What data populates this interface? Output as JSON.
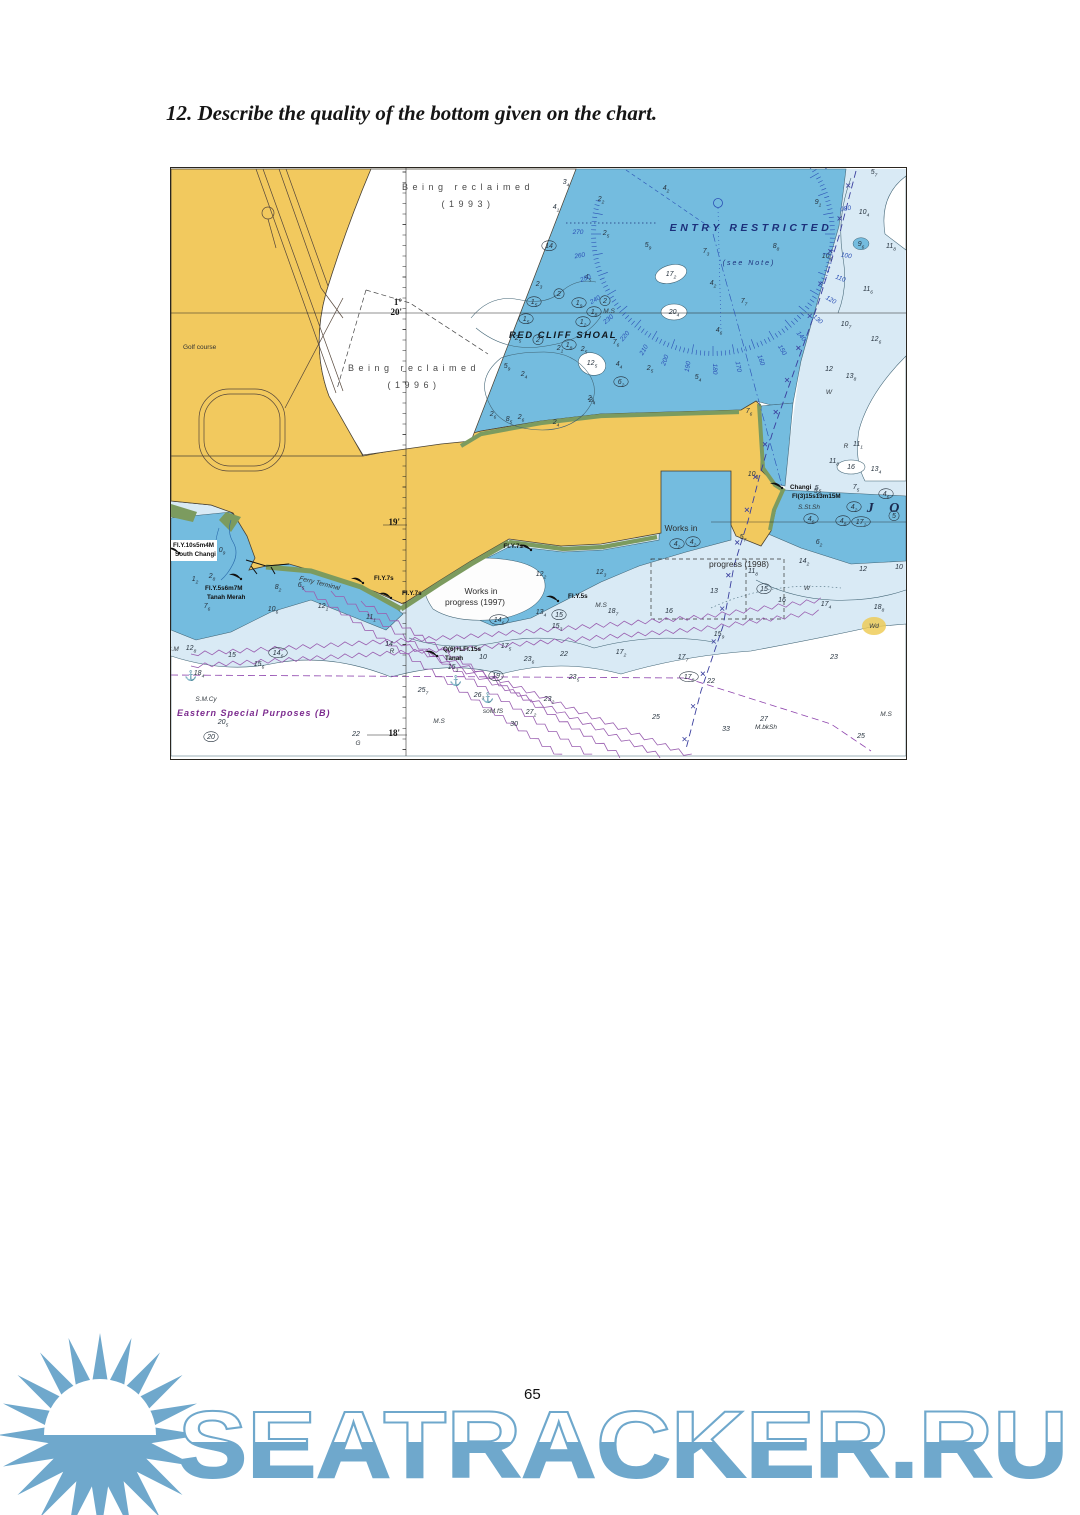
{
  "page": {
    "heading": "12. Describe the quality of the bottom given on the chart.",
    "page_number": "65"
  },
  "watermark": {
    "text": "SEATRACKER.RU",
    "color": "#6fa8cc"
  },
  "chart": {
    "colors": {
      "land": "#f2c95e",
      "green": "#7c9b5f",
      "water": "#74bcdf",
      "shallow_pale": "#d9eaf5",
      "deep": "#ffffff",
      "contour": "#3f6273",
      "sounding": "#26323e",
      "compass": "#2b50b5",
      "navy": "#1c2f7a",
      "cable_purple": "#9a5fb0",
      "anchorage_purple": "#8e44ad",
      "magenta": "#7b2a8e",
      "boundary": "#3a3f9e",
      "highlight": "#edc94f"
    },
    "labels": {
      "reclaimed_1993_l1": "Being reclaimed",
      "reclaimed_1993_l2": "(1993)",
      "reclaimed_1996_l1": "Being reclaimed",
      "reclaimed_1996_l2": "(1996)",
      "entry_restricted": "ENTRY   RESTRICTED",
      "see_note": "(see Note)",
      "red_cliff_shoal": "RED CLIFF SHOAL",
      "golf_course": "Golf course",
      "works_1998_l1": "Works in",
      "works_1998_l2": "progress (1998)",
      "works_1997_l1": "Works in",
      "works_1997_l2": "progress (1997)",
      "eastern_special": "Eastern Special Purposes  (B)",
      "ferry_terminal": "Ferry Terminal",
      "johor": "J O",
      "lat_deg": "1°",
      "lat_20": "20'",
      "lat_19": "19'",
      "lat_18": "18'"
    },
    "areas": [
      {
        "t": "Being reclaimed",
        "x": 297,
        "y": 22,
        "cls": "recl",
        "a": "middle"
      },
      {
        "t": "(1993)",
        "x": 297,
        "y": 39,
        "cls": "recl",
        "a": "middle"
      },
      {
        "t": "Being reclaimed",
        "x": 243,
        "y": 203,
        "cls": "recl",
        "a": "middle"
      },
      {
        "t": "(1996)",
        "x": 243,
        "y": 220,
        "cls": "recl",
        "a": "middle"
      },
      {
        "t": "ENTRY   RESTRICTED",
        "x": 580,
        "y": 63,
        "cls": "entry",
        "a": "middle"
      },
      {
        "t": "(see Note)",
        "x": 578,
        "y": 97,
        "cls": "note",
        "a": "middle"
      },
      {
        "t": "RED CLIFF SHOAL",
        "x": 392,
        "y": 170,
        "cls": "shoal",
        "a": "middle"
      },
      {
        "t": "Golf course",
        "x": 12,
        "y": 181,
        "cls": "golf",
        "a": "start"
      },
      {
        "t": "Works in",
        "x": 510,
        "y": 363,
        "cls": "works",
        "a": "middle"
      },
      {
        "t": "progress (1998)",
        "x": 568,
        "y": 399,
        "cls": "works",
        "a": "middle"
      },
      {
        "t": "Works in",
        "x": 310,
        "y": 426,
        "cls": "works",
        "a": "middle"
      },
      {
        "t": "progress (1997)",
        "x": 304,
        "y": 437,
        "cls": "works",
        "a": "middle"
      },
      {
        "t": "Eastern Special Purposes  (B)",
        "x": 6,
        "y": 548,
        "cls": "esp",
        "a": "start"
      },
      {
        "t": "Ferry Terminal",
        "x": 128,
        "y": 412,
        "cls": "ferry",
        "a": "start",
        "r": 14
      },
      {
        "t": "J O",
        "x": 715,
        "y": 344,
        "cls": "jo",
        "a": "middle"
      },
      {
        "t": "1°",
        "x": 231,
        "y": 137,
        "cls": "lat",
        "a": "end"
      },
      {
        "t": "20'",
        "x": 231,
        "y": 147,
        "cls": "lat",
        "a": "end"
      },
      {
        "t": "19'",
        "x": 229,
        "y": 357,
        "cls": "lat",
        "a": "end"
      },
      {
        "t": "18'",
        "x": 229,
        "y": 568,
        "cls": "lat",
        "a": "end"
      }
    ],
    "lights": [
      {
        "fx": 8,
        "fy": 385,
        "tx": 2,
        "ty": 379,
        "t1": "Fl.Y.10s5m4M",
        "t2": "South Changi",
        "bg": true
      },
      {
        "fx": 70,
        "fy": 411,
        "tx": 34,
        "ty": 422,
        "t1": "Fl.Y.5s6m7M",
        "t2": "Tanah Merah"
      },
      {
        "fx": 360,
        "fy": 382,
        "tx": 352,
        "ty": 380,
        "t1": "Fl.Y.7s",
        "a": "end"
      },
      {
        "fx": 192,
        "fy": 415,
        "tx": 203,
        "ty": 412,
        "t1": "Fl.Y.7s"
      },
      {
        "fx": 220,
        "fy": 430,
        "tx": 231,
        "ty": 427,
        "t1": "Fl.Y.7s"
      },
      {
        "fx": 387,
        "fy": 433,
        "tx": 397,
        "ty": 430,
        "t1": "Fl.Y.5s"
      },
      {
        "fx": 611,
        "fy": 320,
        "tx": 619,
        "ty": 321,
        "t1": "Changi",
        "t2": "Fl(3)15s13m15M"
      },
      {
        "fx": 266,
        "fy": 488,
        "tx": 272,
        "ty": 483,
        "t1": "Q(6)+LFl.15s",
        "t2": "Tanah"
      }
    ],
    "soundings": [
      [
        395,
        16,
        "3",
        "4"
      ],
      [
        385,
        41,
        "4",
        "1"
      ],
      [
        430,
        33,
        "2",
        "2"
      ],
      [
        435,
        67,
        "2",
        "5"
      ],
      [
        495,
        22,
        "4",
        "2"
      ],
      [
        477,
        79,
        "5",
        "9"
      ],
      [
        535,
        85,
        "7",
        "3"
      ],
      [
        605,
        80,
        "8",
        "8"
      ],
      [
        542,
        117,
        "4",
        "2"
      ],
      [
        573,
        135,
        "7",
        "7"
      ],
      [
        548,
        164,
        "4",
        "6"
      ],
      [
        417,
        111,
        "4",
        "5"
      ],
      [
        438,
        145,
        "M.S",
        "",
        "q"
      ],
      [
        647,
        36,
        "9",
        "1"
      ],
      [
        703,
        6,
        "5",
        "7"
      ],
      [
        693,
        46,
        "10",
        "4"
      ],
      [
        690,
        78,
        "9",
        "6",
        "b"
      ],
      [
        720,
        80,
        "11",
        "8"
      ],
      [
        656,
        90,
        "10",
        "6"
      ],
      [
        697,
        123,
        "11",
        "6"
      ],
      [
        675,
        158,
        "10",
        "7"
      ],
      [
        705,
        173,
        "12",
        "6"
      ],
      [
        680,
        210,
        "13",
        "8"
      ],
      [
        658,
        203,
        "12",
        ""
      ],
      [
        658,
        226,
        "W",
        "",
        "q"
      ],
      [
        578,
        245,
        "7",
        "6"
      ],
      [
        582,
        308,
        "10",
        "8"
      ],
      [
        368,
        118,
        "2",
        "3"
      ],
      [
        388,
        128,
        "2",
        "",
        "c"
      ],
      [
        363,
        136,
        "1",
        "5",
        "c"
      ],
      [
        408,
        137,
        "1",
        "9",
        "c"
      ],
      [
        434,
        135,
        "2",
        "",
        "c"
      ],
      [
        423,
        146,
        "1",
        "8",
        "c"
      ],
      [
        355,
        153,
        "1",
        "5",
        "c"
      ],
      [
        412,
        156,
        "1",
        "2",
        "c"
      ],
      [
        378,
        80,
        "14",
        "",
        "c"
      ],
      [
        347,
        172,
        "2",
        "5"
      ],
      [
        367,
        174,
        "2",
        "",
        "c"
      ],
      [
        389,
        182,
        "2",
        "1"
      ],
      [
        398,
        179,
        "1",
        "8",
        "c"
      ],
      [
        413,
        183,
        "2",
        "5"
      ],
      [
        445,
        176,
        "7",
        "6"
      ],
      [
        421,
        197,
        "12",
        "5"
      ],
      [
        448,
        198,
        "4",
        "4"
      ],
      [
        450,
        216,
        "6",
        "2",
        "c"
      ],
      [
        479,
        202,
        "2",
        "5"
      ],
      [
        527,
        211,
        "5",
        "4"
      ],
      [
        420,
        232,
        "2",
        "4"
      ],
      [
        336,
        200,
        "5",
        "9"
      ],
      [
        353,
        208,
        "2",
        "4"
      ],
      [
        322,
        248,
        "2",
        "6"
      ],
      [
        338,
        253,
        "8",
        "5"
      ],
      [
        350,
        251,
        "2",
        "6"
      ],
      [
        385,
        256,
        "2",
        "4"
      ],
      [
        421,
        234,
        "2",
        "4"
      ],
      [
        500,
        108,
        "17",
        "2"
      ],
      [
        503,
        146,
        "20",
        "4"
      ],
      [
        675,
        280,
        "R",
        "",
        "q"
      ],
      [
        687,
        278,
        "11",
        "1"
      ],
      [
        663,
        295,
        "11",
        "8"
      ],
      [
        705,
        303,
        "13",
        "4"
      ],
      [
        680,
        301,
        "16",
        ""
      ],
      [
        647,
        322,
        "5",
        "5"
      ],
      [
        685,
        321,
        "7",
        "5"
      ],
      [
        715,
        328,
        "4",
        "6",
        "c"
      ],
      [
        683,
        341,
        "4",
        "2",
        "c"
      ],
      [
        723,
        350,
        "5",
        "",
        "c"
      ],
      [
        672,
        355,
        "4",
        "8",
        "c"
      ],
      [
        690,
        356,
        "17",
        "2",
        "c"
      ],
      [
        640,
        353,
        "4",
        "6",
        "c"
      ],
      [
        648,
        376,
        "6",
        "2"
      ],
      [
        633,
        395,
        "14",
        "2"
      ],
      [
        582,
        405,
        "11",
        "8"
      ],
      [
        692,
        403,
        "12",
        ""
      ],
      [
        728,
        401,
        "10",
        ""
      ],
      [
        543,
        425,
        "13",
        ""
      ],
      [
        548,
        468,
        "15",
        "9"
      ],
      [
        572,
        371,
        "5",
        "7"
      ],
      [
        638,
        341,
        "S.St.Sh",
        "",
        "q"
      ],
      [
        370,
        408,
        "12",
        "2"
      ],
      [
        430,
        406,
        "12",
        "3"
      ],
      [
        370,
        446,
        "13",
        "4"
      ],
      [
        388,
        449,
        "15",
        "",
        "c"
      ],
      [
        386,
        460,
        "15",
        "3"
      ],
      [
        328,
        454,
        "14",
        "6",
        "c"
      ],
      [
        430,
        439,
        "M.S",
        "",
        "q"
      ],
      [
        442,
        445,
        "18",
        "7"
      ],
      [
        498,
        445,
        "16",
        ""
      ],
      [
        450,
        486,
        "17",
        "2"
      ],
      [
        512,
        491,
        "17",
        "7"
      ],
      [
        335,
        480,
        "17",
        "5"
      ],
      [
        393,
        488,
        "22",
        ""
      ],
      [
        358,
        493,
        "23",
        "6"
      ],
      [
        403,
        511,
        "23",
        "5"
      ],
      [
        325,
        510,
        "19",
        "",
        "c"
      ],
      [
        308,
        529,
        "26",
        "3"
      ],
      [
        322,
        545,
        "soM.fS",
        "",
        "q"
      ],
      [
        360,
        546,
        "27",
        "2"
      ],
      [
        268,
        555,
        "M.S",
        "",
        "q"
      ],
      [
        343,
        558,
        "30",
        ""
      ],
      [
        252,
        524,
        "25",
        "7"
      ],
      [
        282,
        501,
        "15",
        "3"
      ],
      [
        312,
        491,
        "10",
        ""
      ],
      [
        51,
        384,
        "0",
        "9"
      ],
      [
        41,
        410,
        "2",
        "8"
      ],
      [
        24,
        413,
        "1",
        "2"
      ],
      [
        36,
        440,
        "7",
        "6"
      ],
      [
        130,
        419,
        "6",
        "5"
      ],
      [
        107,
        421,
        "8",
        "2"
      ],
      [
        152,
        440,
        "12",
        "1"
      ],
      [
        102,
        443,
        "10",
        "6"
      ],
      [
        200,
        451,
        "11",
        "1"
      ],
      [
        2,
        483,
        "S.M",
        "",
        "q"
      ],
      [
        20,
        482,
        "12",
        "8"
      ],
      [
        61,
        489,
        "15",
        ""
      ],
      [
        107,
        487,
        "14",
        "6",
        "c"
      ],
      [
        88,
        498,
        "15",
        "6"
      ],
      [
        218,
        478,
        "14",
        ""
      ],
      [
        221,
        485,
        "R",
        "",
        "q"
      ],
      [
        28,
        507,
        "18",
        "4"
      ],
      [
        35,
        533,
        "S.M.Cy",
        "",
        "q"
      ],
      [
        52,
        556,
        "20",
        "5"
      ],
      [
        40,
        571,
        "20",
        "",
        "c"
      ],
      [
        185,
        568,
        "22",
        ""
      ],
      [
        187,
        577,
        "G",
        "",
        "q"
      ],
      [
        378,
        533,
        "23",
        "2"
      ],
      [
        663,
        491,
        "23",
        ""
      ],
      [
        540,
        515,
        "22",
        ""
      ],
      [
        655,
        438,
        "17",
        "4"
      ],
      [
        708,
        441,
        "18",
        "8"
      ],
      [
        611,
        434,
        "16",
        ""
      ],
      [
        703,
        460,
        "Wd",
        "",
        "h"
      ],
      [
        636,
        422,
        "W",
        "",
        "q"
      ],
      [
        593,
        423,
        "15",
        "",
        "c"
      ],
      [
        715,
        548,
        "M.S",
        "",
        "q"
      ],
      [
        593,
        553,
        "27",
        ""
      ],
      [
        595,
        561,
        "M.bkSh",
        "",
        "q"
      ],
      [
        485,
        551,
        "25",
        ""
      ],
      [
        555,
        563,
        "33",
        ""
      ],
      [
        690,
        570,
        "25",
        ""
      ],
      [
        518,
        511,
        "17",
        "8",
        "c"
      ],
      [
        506,
        378,
        "4",
        "2",
        "c"
      ],
      [
        522,
        376,
        "4",
        "2",
        "c"
      ],
      [
        646,
        325,
        "5",
        "5"
      ],
      [
        20,
        511,
        "",
        "",
        "a"
      ],
      [
        285,
        516,
        "",
        "",
        "a"
      ],
      [
        317,
        533,
        "",
        "",
        "a"
      ]
    ],
    "compass": {
      "cx": 542,
      "cy": 66,
      "r": 122,
      "label_r": 135,
      "tick_start": 56,
      "tick_end": 286,
      "bearings": [
        "060",
        "080",
        "100",
        "110",
        "120",
        "130",
        "140",
        "150",
        "160",
        "170",
        "180",
        "190",
        "200",
        "210",
        "220",
        "230",
        "240",
        "250",
        "260",
        "270"
      ]
    }
  }
}
